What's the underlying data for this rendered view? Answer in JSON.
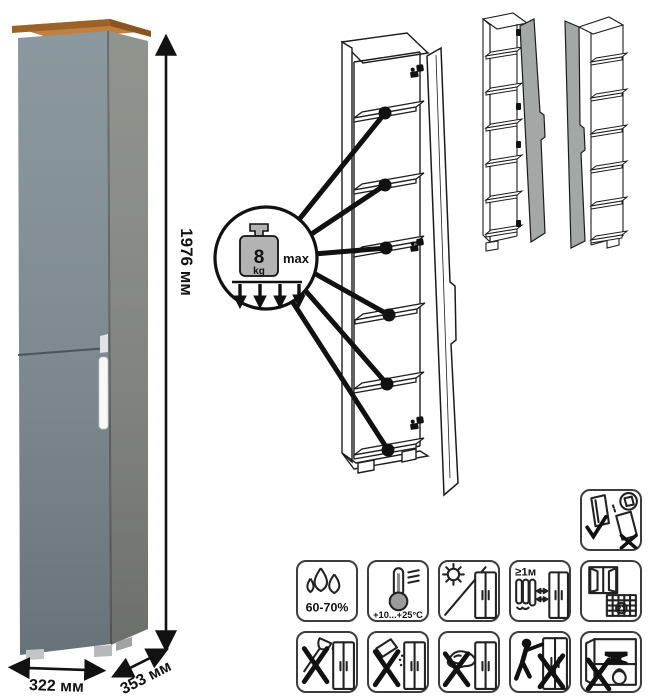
{
  "product_photo": {
    "height_label": "1976 мм",
    "width_label": "322 мм",
    "depth_label": "353 мм",
    "colors": {
      "wood_top": "#c08140",
      "door_front": "#7e8c93",
      "side_panel": "#848881",
      "handle": "#f7f9f9"
    }
  },
  "load_callout": {
    "value": "8",
    "unit": "kg",
    "max_label": "max"
  },
  "icons": {
    "door_handling": {
      "name": "door-storage-upright-icon"
    },
    "row1": [
      {
        "name": "humidity-icon",
        "label": "60-70%"
      },
      {
        "name": "temperature-range-icon",
        "label": "+10...+25°C"
      },
      {
        "name": "no-direct-sunlight-icon",
        "label": ""
      },
      {
        "name": "heat-source-distance-icon",
        "label": "≥1м"
      },
      {
        "name": "ventilation-acclimatization-icon",
        "calendar_day": "21"
      }
    ],
    "row2": [
      {
        "name": "no-sharp-tools-icon"
      },
      {
        "name": "no-abrasive-cleaners-icon"
      },
      {
        "name": "no-wet-cloth-icon"
      },
      {
        "name": "no-dragging-icon"
      },
      {
        "name": "no-heavy-items-icon"
      }
    ]
  }
}
